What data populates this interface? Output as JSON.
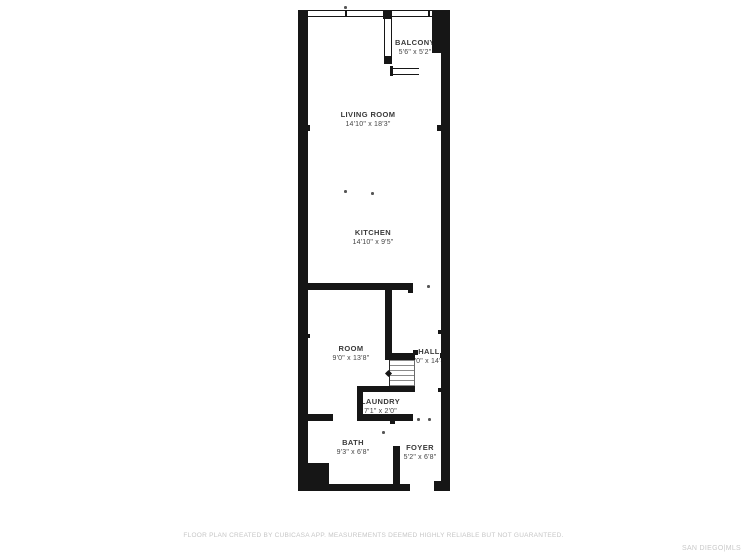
{
  "floor_plan": {
    "rooms": [
      {
        "id": "balcony",
        "name": "BALCONY",
        "dims": "5'6\" x 5'2\""
      },
      {
        "id": "living-room",
        "name": "LIVING ROOM",
        "dims": "14'10\" x 18'3\""
      },
      {
        "id": "kitchen",
        "name": "KITCHEN",
        "dims": "14'10\" x 9'5\""
      },
      {
        "id": "room",
        "name": "ROOM",
        "dims": "9'0\" x 13'8\""
      },
      {
        "id": "hall",
        "name": "HALL",
        "dims": "3'0\" x 14'4\""
      },
      {
        "id": "laundry",
        "name": "LAUNDRY",
        "dims": "7'1\" x 2'0\""
      },
      {
        "id": "bath",
        "name": "BATH",
        "dims": "9'3\" x 6'8\""
      },
      {
        "id": "foyer",
        "name": "FOYER",
        "dims": "5'2\" x 6'8\""
      }
    ],
    "colors": {
      "wall": "#161616",
      "label_text": "#3a3a3a",
      "footer_text": "#c6c6c6",
      "background": "#ffffff"
    }
  },
  "footer": {
    "disclaimer": "FLOOR PLAN CREATED BY CUBICASA APP. MEASUREMENTS DEEMED HIGHLY RELIABLE BUT NOT GUARANTEED.",
    "brand": "SAN DIEGO|MLS"
  }
}
